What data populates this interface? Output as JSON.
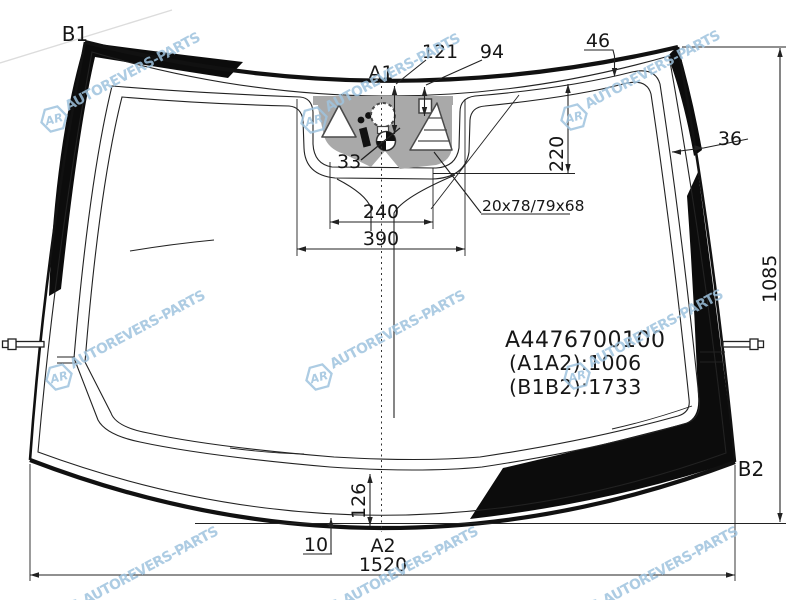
{
  "diagram": {
    "corner_labels": {
      "b1": "B1",
      "b2": "B2",
      "a1": "A1",
      "a2": "A2"
    },
    "dimensions": {
      "offset_121": "121",
      "offset_94": "94",
      "band_top": "46",
      "band_side": "36",
      "sensor_depth": "220",
      "glass_height": "1085",
      "notch_inner": "240",
      "notch_outer": "390",
      "sensor_mark": "33",
      "bottom_band": "126",
      "edge_offset": "10",
      "glass_width": "1520",
      "sensor_windows": "20x78/79x68"
    },
    "part": {
      "number": "A4476700100",
      "a1a2": "(A1A2):1006",
      "b1b2": "(B1B2):1733"
    },
    "watermark": {
      "text": "AUTOREVERS-PARTS",
      "logo": "AR",
      "color": "#9fc3de"
    },
    "colors": {
      "line": "#1a1a1a",
      "bracket": "#a9a9a9"
    }
  }
}
